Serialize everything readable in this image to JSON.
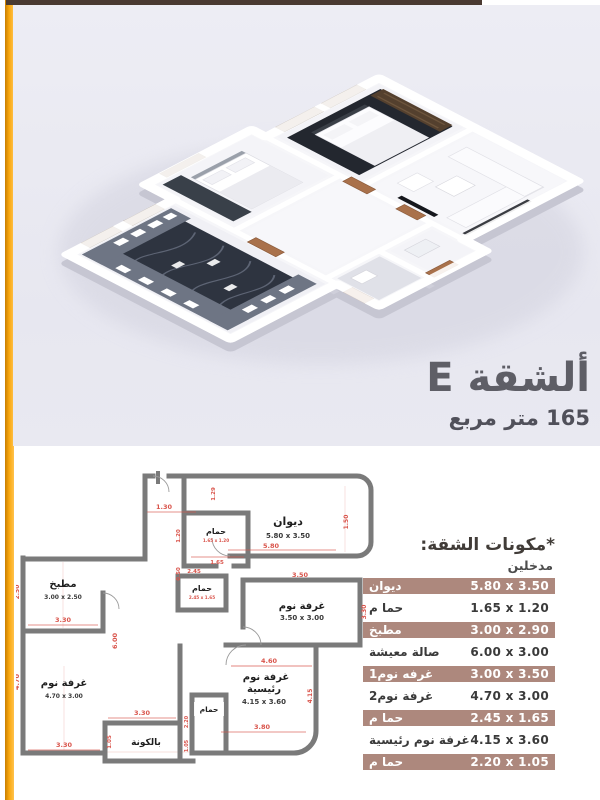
{
  "page": {
    "accent_orange": "#f9a70d",
    "topbar_brown": "#4a3a31",
    "panel_bg": "#e9e9f1",
    "highlight_row_bg": "#ad887d",
    "dimension_red": "#d9534a",
    "wall_gray": "#7a7a7a"
  },
  "header": {
    "apartment_title": "ألشقة E",
    "area_subtitle": "165 متر مربع"
  },
  "plan2d": {
    "rooms": {
      "diwan": {
        "name": "ديوان",
        "size": "5.80 x 3.50"
      },
      "bath1": {
        "name": "حمام",
        "size": "1.65 x 1.20"
      },
      "bath2": {
        "name": "حمام",
        "size": "2.45 x 1.65"
      },
      "bedroom1": {
        "name": "غرفة نوم",
        "size": "3.50 x 3.00"
      },
      "kitchen": {
        "name": "مطبخ",
        "size": "3.00 x 2.50"
      },
      "bedroom2": {
        "name": "غرفة نوم",
        "size": "4.70 x 3.00"
      },
      "master": {
        "name": "غرفة نوم",
        "name2": "رئيسية",
        "size": "4.15 x 3.60"
      },
      "bath3": {
        "name": "حمام"
      },
      "balcony": {
        "name": "بالكونة"
      }
    },
    "dims": {
      "entry_width": "1.30",
      "entry_side": "1.29",
      "bath1_w": "1.65",
      "bath1_h": "1.20",
      "gap_small": "0.50",
      "diwan_w": "5.80",
      "diwan_side": "1.50",
      "bath2_w": "2.45",
      "bed1_w": "3.50",
      "bed1_h": "3.30",
      "kitchen_h": "2.50",
      "kitchen_w": "3.30",
      "hall_h": "6.00",
      "bed2_h": "4.70",
      "bed2_w": "3.30",
      "hall_w": "3.30",
      "balcony_h": "1.05",
      "master_w_top": "4.60",
      "master_w_bot": "3.80",
      "master_h": "4.15",
      "bath3_h": "2.20",
      "bath3_w": "1.05"
    }
  },
  "components": {
    "title": "*مكونات الشقة:",
    "subtitle": "مدخلين",
    "rows": [
      {
        "name": "ديوان",
        "size": "5.80 x 3.50",
        "highlight": true
      },
      {
        "name": "حما م",
        "size": "1.65 x 1.20",
        "highlight": false
      },
      {
        "name": "مطبخ",
        "size": "3.00 x 2.90",
        "highlight": true
      },
      {
        "name": "صالة معيشة",
        "size": "6.00 x 3.00",
        "highlight": false
      },
      {
        "name": "غرفه نوم1",
        "size": "3.00 x 3.50",
        "highlight": true
      },
      {
        "name": "غرفة نوم2",
        "size": "4.70 x 3.00",
        "highlight": false
      },
      {
        "name": "حما م",
        "size": "2.45 x 1.65",
        "highlight": true
      },
      {
        "name": "غرفة نوم رئيسية",
        "size": "4.15 x 3.60",
        "highlight": false
      },
      {
        "name": "حما م",
        "size": "2.20 x 1.05",
        "highlight": true
      }
    ]
  }
}
